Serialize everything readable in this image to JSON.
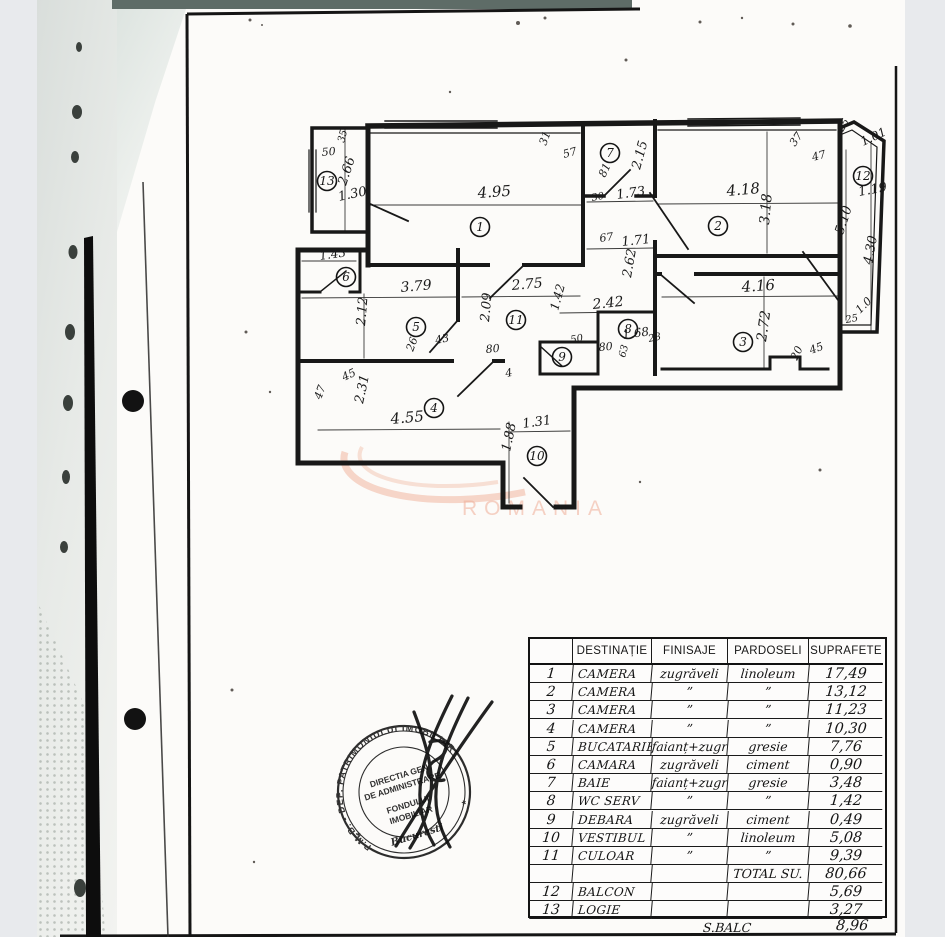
{
  "page": {
    "background": "#e8eaed",
    "paper_color": "#fcfbf9",
    "topbar_color": "#5e6c67"
  },
  "watermark": {
    "text": "ROMANIA",
    "color": "#eda58c"
  },
  "stamp": {
    "ring_text": "P.M.B. - DEP. PATRIMONIULUI  IMOBILIAR",
    "lines": [
      "DIRECTIA GEN",
      "DE ADMINISTRARE",
      "FONDULUI",
      "IMOBILIAR"
    ],
    "city": "Bucuresti"
  },
  "floor_plan": {
    "rooms": [
      {
        "n": "1",
        "x": 480,
        "y": 227
      },
      {
        "n": "2",
        "x": 718,
        "y": 226
      },
      {
        "n": "3",
        "x": 743,
        "y": 342
      },
      {
        "n": "4",
        "x": 434,
        "y": 408
      },
      {
        "n": "5",
        "x": 416,
        "y": 327
      },
      {
        "n": "6",
        "x": 346,
        "y": 277
      },
      {
        "n": "7",
        "x": 610,
        "y": 153
      },
      {
        "n": "8",
        "x": 628,
        "y": 329
      },
      {
        "n": "9",
        "x": 562,
        "y": 357
      },
      {
        "n": "10",
        "x": 537,
        "y": 456
      },
      {
        "n": "11",
        "x": 516,
        "y": 320
      },
      {
        "n": "12",
        "x": 863,
        "y": 176
      },
      {
        "n": "13",
        "x": 327,
        "y": 181
      }
    ],
    "labels": [
      {
        "t": "4.95",
        "x": 478,
        "y": 198,
        "r": -4,
        "s": 15
      },
      {
        "t": "3.18",
        "x": 769,
        "y": 225,
        "r": -85,
        "s": 14
      },
      {
        "t": "4.18",
        "x": 727,
        "y": 196,
        "r": -5,
        "s": 15
      },
      {
        "t": "2.15",
        "x": 640,
        "y": 170,
        "r": -75,
        "s": 13
      },
      {
        "t": "81",
        "x": 605,
        "y": 178,
        "r": -65,
        "s": 11
      },
      {
        "t": "1.73",
        "x": 617,
        "y": 199,
        "r": -8,
        "s": 13
      },
      {
        "t": "30",
        "x": 592,
        "y": 201,
        "r": -10,
        "s": 10
      },
      {
        "t": "67",
        "x": 600,
        "y": 242,
        "r": -8,
        "s": 11
      },
      {
        "t": "1.71",
        "x": 622,
        "y": 246,
        "r": -6,
        "s": 13
      },
      {
        "t": "31",
        "x": 546,
        "y": 146,
        "r": -70,
        "s": 11
      },
      {
        "t": "57",
        "x": 564,
        "y": 158,
        "r": -15,
        "s": 11
      },
      {
        "t": "37",
        "x": 795,
        "y": 147,
        "r": -55,
        "s": 11
      },
      {
        "t": "47",
        "x": 813,
        "y": 161,
        "r": -15,
        "s": 11
      },
      {
        "t": "25",
        "x": 843,
        "y": 132,
        "r": -60,
        "s": 10
      },
      {
        "t": "1.01",
        "x": 863,
        "y": 146,
        "r": -25,
        "s": 12
      },
      {
        "t": "1.19",
        "x": 859,
        "y": 196,
        "r": -10,
        "s": 13
      },
      {
        "t": "5.10",
        "x": 843,
        "y": 235,
        "r": -72,
        "s": 13
      },
      {
        "t": "4.30",
        "x": 872,
        "y": 265,
        "r": -80,
        "s": 13
      },
      {
        "t": "25",
        "x": 846,
        "y": 323,
        "r": -10,
        "s": 10
      },
      {
        "t": "1.0",
        "x": 860,
        "y": 314,
        "r": -45,
        "s": 11
      },
      {
        "t": "4.16",
        "x": 742,
        "y": 292,
        "r": -4,
        "s": 15
      },
      {
        "t": "2.72",
        "x": 766,
        "y": 342,
        "r": -82,
        "s": 14
      },
      {
        "t": "45",
        "x": 811,
        "y": 354,
        "r": -20,
        "s": 11
      },
      {
        "t": "20",
        "x": 797,
        "y": 361,
        "r": -65,
        "s": 11
      },
      {
        "t": "2.62",
        "x": 631,
        "y": 278,
        "r": -80,
        "s": 13
      },
      {
        "t": "2.42",
        "x": 593,
        "y": 309,
        "r": -6,
        "s": 14
      },
      {
        "t": "1.42",
        "x": 558,
        "y": 311,
        "r": -75,
        "s": 12
      },
      {
        "t": "2.75",
        "x": 512,
        "y": 290,
        "r": -5,
        "s": 14
      },
      {
        "t": "2.09",
        "x": 489,
        "y": 322,
        "r": -85,
        "s": 13
      },
      {
        "t": "80",
        "x": 486,
        "y": 353,
        "r": -5,
        "s": 11
      },
      {
        "t": "26",
        "x": 413,
        "y": 352,
        "r": -70,
        "s": 11
      },
      {
        "t": "43",
        "x": 436,
        "y": 344,
        "r": -12,
        "s": 11
      },
      {
        "t": "3.79",
        "x": 401,
        "y": 292,
        "r": -5,
        "s": 14
      },
      {
        "t": "2.12",
        "x": 365,
        "y": 326,
        "r": -85,
        "s": 13
      },
      {
        "t": "1.43",
        "x": 320,
        "y": 260,
        "r": -8,
        "s": 12
      },
      {
        "t": "50",
        "x": 322,
        "y": 156,
        "r": -5,
        "s": 11
      },
      {
        "t": "35",
        "x": 344,
        "y": 143,
        "r": -75,
        "s": 10
      },
      {
        "t": "2.66",
        "x": 346,
        "y": 186,
        "r": -72,
        "s": 13
      },
      {
        "t": "1.30",
        "x": 339,
        "y": 201,
        "r": -12,
        "s": 13
      },
      {
        "t": "45",
        "x": 344,
        "y": 381,
        "r": -25,
        "s": 11
      },
      {
        "t": "47",
        "x": 321,
        "y": 400,
        "r": -70,
        "s": 11
      },
      {
        "t": "2.31",
        "x": 363,
        "y": 404,
        "r": -78,
        "s": 13
      },
      {
        "t": "4.55",
        "x": 391,
        "y": 424,
        "r": -5,
        "s": 15
      },
      {
        "t": "4",
        "x": 506,
        "y": 377,
        "r": -10,
        "s": 11
      },
      {
        "t": "1.31",
        "x": 523,
        "y": 428,
        "r": -8,
        "s": 13
      },
      {
        "t": "1.88",
        "x": 510,
        "y": 452,
        "r": -78,
        "s": 13
      },
      {
        "t": "50",
        "x": 571,
        "y": 343,
        "r": -10,
        "s": 10
      },
      {
        "t": "80",
        "x": 599,
        "y": 351,
        "r": -5,
        "s": 11
      },
      {
        "t": "1.68",
        "x": 623,
        "y": 339,
        "r": -8,
        "s": 12
      },
      {
        "t": "28",
        "x": 649,
        "y": 342,
        "r": -12,
        "s": 10
      },
      {
        "t": "63",
        "x": 625,
        "y": 358,
        "r": -75,
        "s": 10
      }
    ]
  },
  "table": {
    "headers": [
      "",
      "DESTINAȚIE",
      "FINISAJE",
      "PARDOSELI",
      "SUPRAFETE"
    ],
    "rows": [
      {
        "no": "1",
        "dest": "CAMERA",
        "fin": "zugrăveli",
        "par": "linoleum",
        "sup": "17,49"
      },
      {
        "no": "2",
        "dest": "CAMERA",
        "fin": "”",
        "par": "”",
        "sup": "13,12"
      },
      {
        "no": "3",
        "dest": "CAMERA",
        "fin": "”",
        "par": "”",
        "sup": "11,23"
      },
      {
        "no": "4",
        "dest": "CAMERA",
        "fin": "”",
        "par": "”",
        "sup": "10,30"
      },
      {
        "no": "5",
        "dest": "BUCATARIE",
        "fin": "faianț+zugr",
        "par": "gresie",
        "sup": "7,76"
      },
      {
        "no": "6",
        "dest": "CAMARA",
        "fin": "zugrăveli",
        "par": "ciment",
        "sup": "0,90"
      },
      {
        "no": "7",
        "dest": "BAIE",
        "fin": "faianț+zugr",
        "par": "gresie",
        "sup": "3,48"
      },
      {
        "no": "8",
        "dest": "WC SERV",
        "fin": "”",
        "par": "”",
        "sup": "1,42"
      },
      {
        "no": "9",
        "dest": "DEBARA",
        "fin": "zugrăveli",
        "par": "ciment",
        "sup": "0,49"
      },
      {
        "no": "10",
        "dest": "VESTIBUL",
        "fin": "”",
        "par": "linoleum",
        "sup": "5,08"
      },
      {
        "no": "11",
        "dest": "CULOAR",
        "fin": "”",
        "par": "”",
        "sup": "9,39"
      },
      {
        "no": "",
        "dest": "",
        "fin": "",
        "par": "TOTAL SU.",
        "sup": "80,66"
      },
      {
        "no": "12",
        "dest": "BALCON",
        "fin": "",
        "par": "",
        "sup": "5,69"
      },
      {
        "no": "13",
        "dest": "LOGIE",
        "fin": "",
        "par": "",
        "sup": "3,27"
      }
    ],
    "footer": {
      "label": "S.BALC",
      "value": "8,96"
    }
  }
}
